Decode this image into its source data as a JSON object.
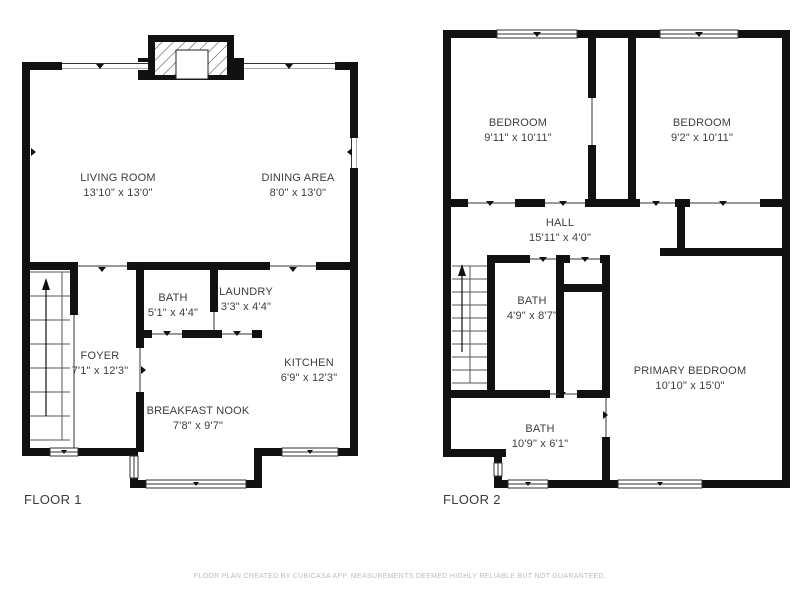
{
  "floor1": {
    "label": "FLOOR 1",
    "rooms": {
      "living": {
        "name": "LIVING ROOM",
        "dims": "13'10\" x 13'0\""
      },
      "dining": {
        "name": "DINING AREA",
        "dims": "8'0\" x 13'0\""
      },
      "bath": {
        "name": "BATH",
        "dims": "5'1\" x 4'4\""
      },
      "laundry": {
        "name": "LAUNDRY",
        "dims": "3'3\" x 4'4\""
      },
      "foyer": {
        "name": "FOYER",
        "dims": "7'1\" x 12'3\""
      },
      "kitchen": {
        "name": "KITCHEN",
        "dims": "6'9\" x 12'3\""
      },
      "nook": {
        "name": "BREAKFAST NOOK",
        "dims": "7'8\" x 9'7\""
      }
    }
  },
  "floor2": {
    "label": "FLOOR 2",
    "rooms": {
      "bedroom_left": {
        "name": "BEDROOM",
        "dims": "9'11\" x 10'11\""
      },
      "bedroom_right": {
        "name": "BEDROOM",
        "dims": "9'2\" x 10'11\""
      },
      "hall": {
        "name": "HALL",
        "dims": "15'11\" x 4'0\""
      },
      "bath_mid": {
        "name": "BATH",
        "dims": "4'9\" x 8'7\""
      },
      "primary": {
        "name": "PRIMARY BEDROOM",
        "dims": "10'10\" x 15'0\""
      },
      "bath_bottom": {
        "name": "BATH",
        "dims": "10'9\" x 6'1\""
      }
    }
  },
  "footer": {
    "disclaimer": "FLOOR PLAN CREATED BY CUBICASA APP. MEASUREMENTS DEEMED HIGHLY RELIABLE BUT NOT GUARANTEED."
  },
  "colors": {
    "background": "#ffffff",
    "wall": "#111111",
    "room_text": "#3d3d3d",
    "floor_label_text": "#3a3a3a",
    "disclaimer_text": "#bcbcbc"
  }
}
